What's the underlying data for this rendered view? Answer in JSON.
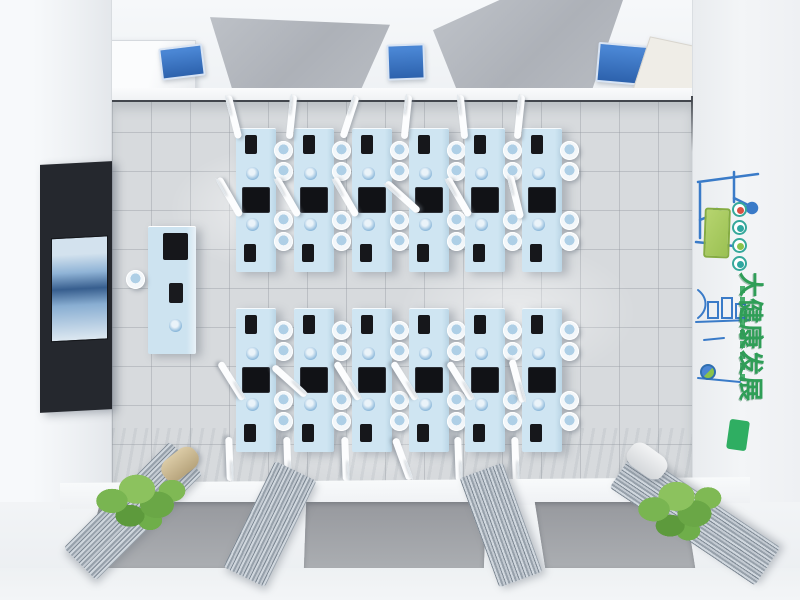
{
  "scene": {
    "description": "Top-down 3D render of a dental simulation training classroom",
    "view": "bird's-eye interior visualization"
  },
  "right_wall_mural": {
    "headline": "大健康发展",
    "headline_color": "#2f9e57",
    "board_color": "#a9cb60",
    "badge_count": 4,
    "exit_sign_color": "#2fae62"
  },
  "equipment": {
    "workbench_rows": 2,
    "workbenches_per_row": 6,
    "workbench_total": 12,
    "stools_per_bench": 4,
    "arms_per_bench": 2,
    "bench_color": "#cfe5f2",
    "monitor_color": "#121317"
  },
  "fixtures": {
    "wall_tv_screens": 1,
    "instructor_stations": 1,
    "ceiling_light_panels": 2,
    "ceiling_ac_units": 1,
    "wall_posters": 3,
    "window_curtains": 4,
    "window_panes": 3,
    "plants": 2
  },
  "palette": {
    "floor": "#d7dadd",
    "walls": "#f2f4f6",
    "bench_blue": "#cfe5f2",
    "poster_blue": "#3a6fc0",
    "mural_green": "#2f9e57",
    "plant_green": "#6aa746",
    "curtain_gray": "#aab3bd"
  },
  "layout": {
    "bench_cols_x": [
      236,
      294,
      352,
      409,
      465,
      522
    ],
    "bench_rows": [
      {
        "y": 128,
        "dir": "up"
      },
      {
        "y": 308,
        "dir": "down"
      }
    ],
    "bench_w": 40,
    "bench_h": 144
  }
}
